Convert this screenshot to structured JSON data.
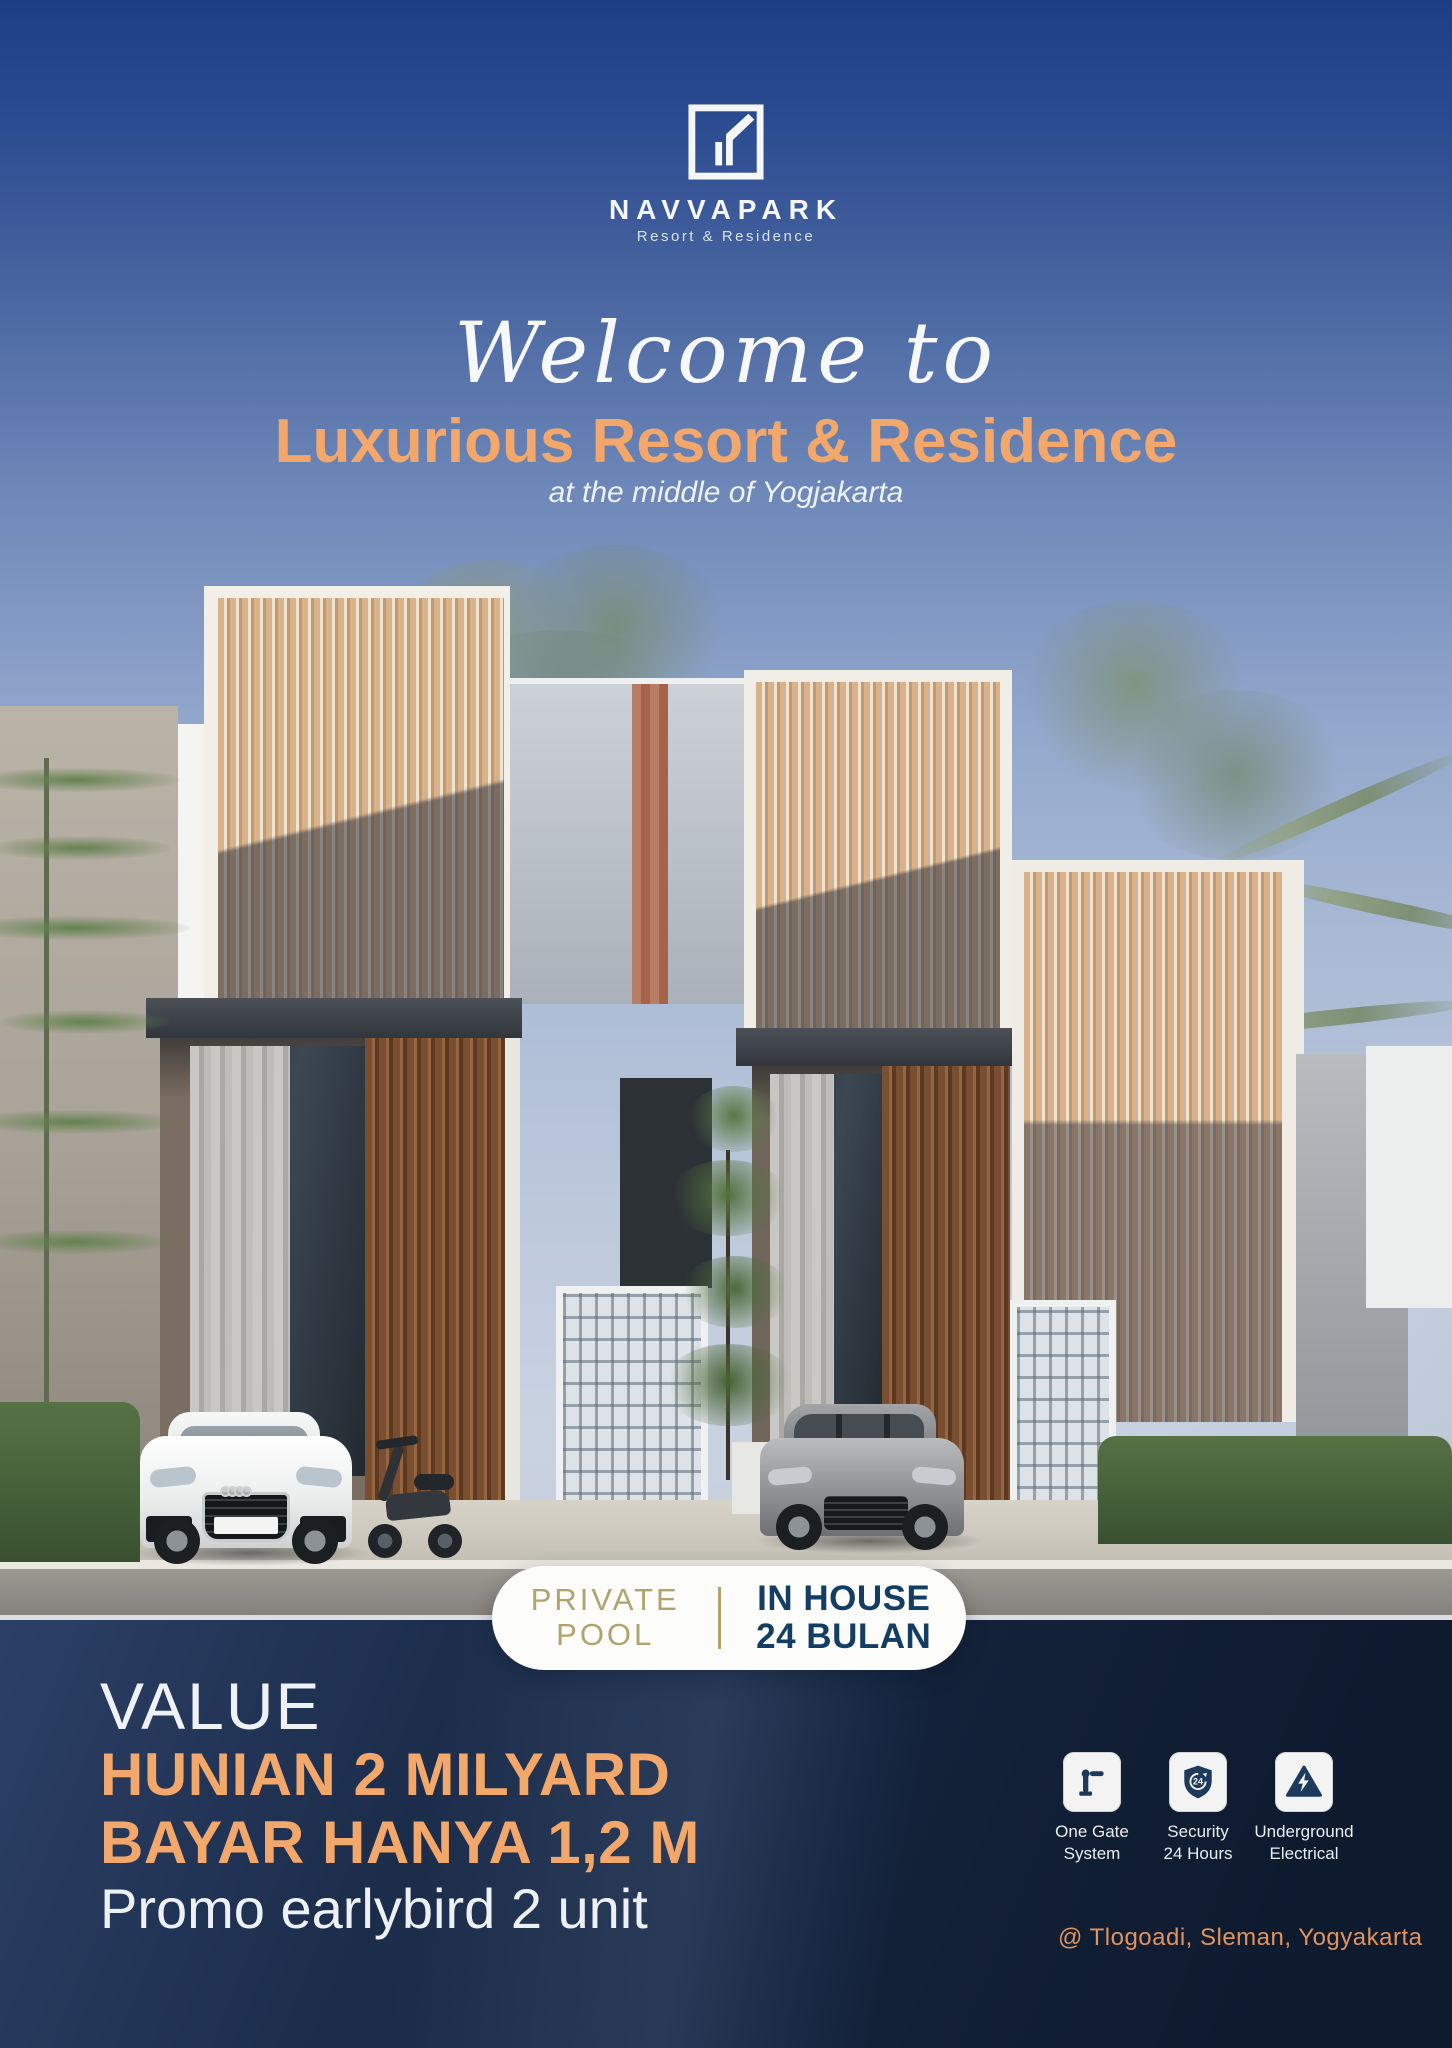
{
  "poster": {
    "brand": {
      "name": "NAVVAPARK",
      "tagline": "Resort & Residence",
      "logo": "navvapark-square-mark"
    },
    "hero": {
      "script": "Welcome to",
      "headline": "Luxurious Resort & Residence",
      "subheadline": "at the middle of Yogjakarta"
    },
    "badge": {
      "left1": "PRIVATE",
      "left2": "POOL",
      "right1": "IN HOUSE",
      "right2": "24 BULAN"
    },
    "offer": {
      "label": "VALUE",
      "line1": "HUNIAN 2 MILYARD",
      "line2": "BAYAR HANYA 1,2 M",
      "line3": "Promo earlybird 2 unit"
    },
    "features": [
      {
        "icon": "gate-barrier-icon",
        "line1": "One Gate",
        "line2": "System"
      },
      {
        "icon": "shield-24-icon",
        "icon_text": "24",
        "line1": "Security",
        "line2": "24 Hours"
      },
      {
        "icon": "electric-hazard-icon",
        "line1": "Underground",
        "line2": "Electrical"
      }
    ],
    "location": "@ Tlogoadi, Sleman, Yogyakarta",
    "scene": {
      "description": "Row of modern two-storey resort townhouses with wooden slat screens, white convertible sports car, scooters and silver SUV parked in carports, topiary and tropical trees under a blue sky"
    },
    "colors": {
      "accent_orange": "#F2A76B",
      "badge_gold": "#B2A26D",
      "badge_navy": "#133D63",
      "panel_navy": "#14233C",
      "sky_top": "#1D3E85",
      "location_orange": "#E0935E"
    }
  }
}
